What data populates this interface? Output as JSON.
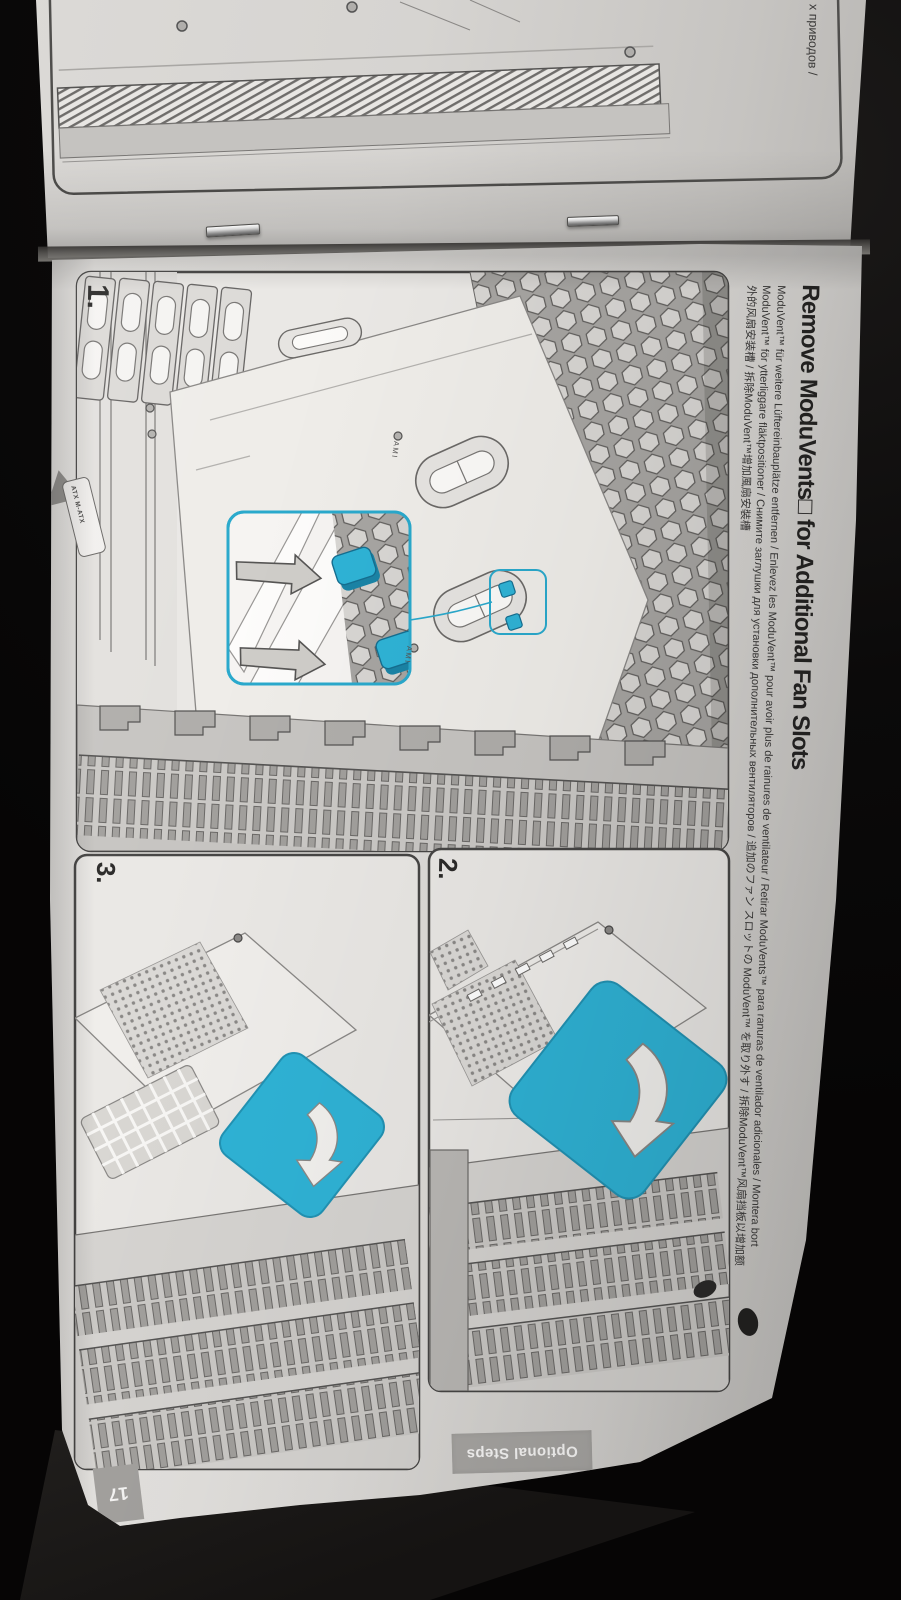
{
  "prev_page": {
    "fragment_text": "х приводов /"
  },
  "page": {
    "title": "Remove ModuVents□ for Additional Fan Slots",
    "subtitle_lines": [
      "ModuVent™ für weitere Lüftereinbauplätze entfernen / Enlevez les ModuVent™ pour avoir plus de rainures de ventilateur / Retirar ModuVents™ para ranuras de ventilador adicionales / Montera bort",
      "ModuVent™ för ytterliggare fläktpositioner / Снимите заглушки для установки дополнительных вентиляторов / 追加のファン スロットの ModuVent™ を取り外す / 拆除ModuVent™风扇挡板以增加额",
      "外的风扇安装槽 / 拆除ModuVent™增加風扇安裝槽"
    ],
    "step_labels": [
      "1.",
      "2.",
      "3."
    ],
    "tab_label": "Optional Steps",
    "page_number": "17",
    "illustration_text": {
      "ami_top": "AMI",
      "ami_bottom": "AMI",
      "atx": "ATX M-ATX"
    },
    "colors": {
      "accent_blue": "#2fb3d6",
      "callout_border": "#2aa9cc"
    }
  }
}
